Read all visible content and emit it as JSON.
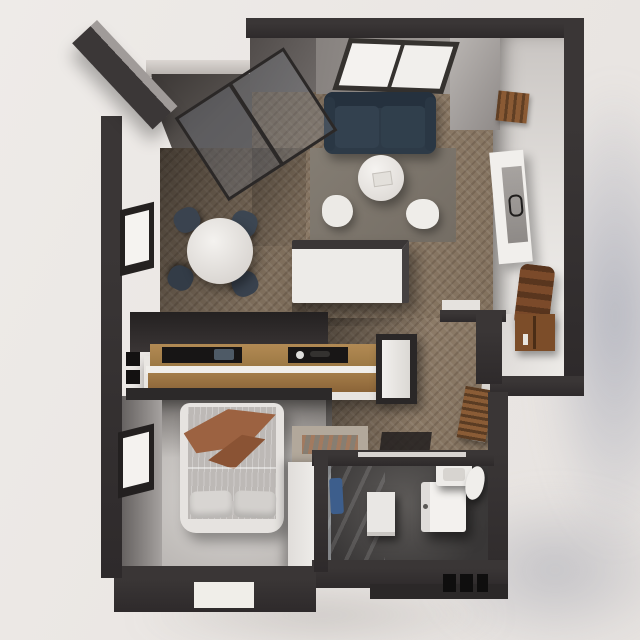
{
  "scene": {
    "title": "Top-down 3D render of a studio apartment floor plan",
    "view": "axonometric top view",
    "background_color": "#eae6e3",
    "drop_shadow_color": "#9aa0b4"
  },
  "palette": {
    "outer_wall": "#332f30",
    "inner_wall_gray": "#8f8b89",
    "wood_floor_herringbone": "#8b7a69",
    "light_floor": "#dcd8d5",
    "bedroom_floor": "#c9c5c2",
    "bathroom_floor": "#454342",
    "terrace_floor": "#57524f",
    "sofa_navy": "#2d3a47",
    "counter_wood": "#a8814c",
    "chair_wood": "#7b4a2a",
    "blanket_rust": "#9c6241",
    "towel_blue": "#3d5e8c",
    "furniture_white": "#efedea"
  },
  "rooms": [
    {
      "id": "living-room",
      "furniture": [
        "sofa",
        "skylight-window",
        "coffee-table",
        "pouf-left",
        "pouf-right",
        "rug",
        "kitchen-island"
      ]
    },
    {
      "id": "dining-area",
      "furniture": [
        "round-table",
        "chair-nw",
        "chair-ne",
        "chair-sw",
        "chair-se",
        "window"
      ]
    },
    {
      "id": "terrace",
      "furniture": [
        "glass-sliding-doors",
        "parapet"
      ]
    },
    {
      "id": "kitchen",
      "furniture": [
        "wood-counter",
        "cooktop-recess",
        "sink-recess",
        "wall-switches",
        "fridge"
      ]
    },
    {
      "id": "hallway",
      "furniture": [
        "floor-mat",
        "slat-radiator"
      ]
    },
    {
      "id": "entry",
      "furniture": [
        "console-cabinet"
      ]
    },
    {
      "id": "study-nook",
      "furniture": [
        "console-table",
        "tray",
        "lounge-chair",
        "wall-coat-rack"
      ]
    },
    {
      "id": "bedroom",
      "furniture": [
        "double-bed",
        "blanket",
        "pillow-left",
        "pillow-right",
        "wardrobe",
        "bench-with-tray",
        "window"
      ]
    },
    {
      "id": "bathroom",
      "furniture": [
        "shower-glass",
        "towel",
        "laundry-cabinet",
        "washing-machine",
        "sink",
        "toilet"
      ]
    }
  ]
}
